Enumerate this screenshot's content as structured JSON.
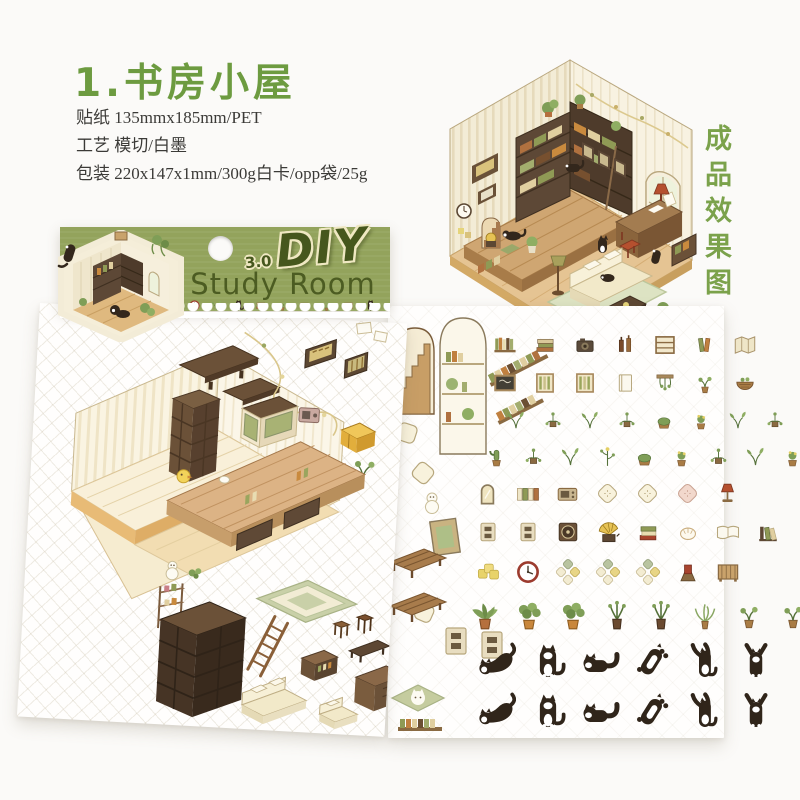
{
  "page": {
    "background": "#fbfaf8"
  },
  "header": {
    "title": "1.书房小屋",
    "specs": [
      "贴纸 135mmx185mm/PET",
      "工艺 模切/白墨",
      "包装 220x147x1mm/300g白卡/opp袋/25g"
    ]
  },
  "side_label": "成品效果图",
  "package_card": {
    "series_version": "3.0",
    "brand": "DIY",
    "product_name": "Study Room",
    "icon_row": [
      "wall-clock",
      "sprig",
      "cat-sit",
      "book-stack",
      "sprout-pot",
      "radio-box",
      "fern-plant",
      "book-stack",
      "cat-sit"
    ]
  },
  "colors": {
    "accent_green": "#6d9b40",
    "label_green": "#7ba24b",
    "card_green": "#93a35c",
    "logo_green": "#46571d",
    "text_dark": "#3b3a37",
    "wood_dark": "#5d4836",
    "wood_mid": "#8a6848",
    "wood_light": "#c9a26b",
    "cream": "#f3ecd2",
    "cat_black": "#30251a",
    "leaf_green": "#7f9e57",
    "rug_sage": "#ccd3ab"
  },
  "left_sheet": {
    "stickers": [
      "room-template",
      "wall-shelf",
      "wall-shelf-small",
      "gold-frame",
      "slat-frame",
      "garland",
      "cubby-shelf",
      "sideboard",
      "mini-radio",
      "yellow-crate",
      "sprig",
      "duck",
      "platform-table",
      "drawer-box",
      "snowman",
      "green-rug",
      "etagere",
      "dark-bookshelf",
      "ladder",
      "sofa",
      "armchair",
      "low-cabinet",
      "stool",
      "stool",
      "bench",
      "desk"
    ]
  },
  "right_sheet": {
    "side_items": [
      "arch-stairs",
      "arch-bookshelf",
      "book-strip",
      "book-strip",
      "cushion",
      "cushion",
      "snowman",
      "photo-frame",
      "bench",
      "bench",
      "cushion",
      "switch-plate",
      "switch-plate",
      "cat-rug",
      "book-strip"
    ],
    "rows": [
      {
        "y": 26,
        "x": 104,
        "size": 26,
        "gap": 14,
        "items": [
          "book-row",
          "book-stack",
          "toy-camera",
          "bottles",
          "slat-shelf",
          "lean-books",
          "folded-map"
        ]
      },
      {
        "y": 64,
        "x": 104,
        "size": 26,
        "gap": 14,
        "items": [
          "blackboard",
          "window-slat",
          "window-slat",
          "white-book",
          "hanging-plant",
          "sprout-pot",
          "basket"
        ]
      },
      {
        "y": 102,
        "x": 116,
        "size": 24,
        "gap": 13,
        "items": [
          "sprig",
          "sprig-drape",
          "sprig",
          "sprig-drape",
          "moss-pot",
          "flower-pot",
          "sprig",
          "sprig-drape"
        ]
      },
      {
        "y": 138,
        "x": 96,
        "size": 25,
        "gap": 12,
        "items": [
          "cactus",
          "sprig-drape",
          "sprig",
          "sprig-tall",
          "moss-pot",
          "flower-pot",
          "sprig-drape",
          "sprig",
          "flower-pot"
        ]
      },
      {
        "y": 174,
        "x": 86,
        "size": 27,
        "gap": 13,
        "items": [
          "mirror",
          "book-files",
          "radio-box",
          "cushion",
          "cushion",
          "cushion-pink",
          "lamp-red"
        ]
      },
      {
        "y": 212,
        "x": 86,
        "size": 28,
        "gap": 12,
        "items": [
          "switch-plate",
          "switch-plate",
          "speaker-box",
          "gramophone",
          "book-stack-red",
          "bun",
          "open-book",
          "bookend"
        ]
      },
      {
        "y": 252,
        "x": 86,
        "size": 28,
        "gap": 12,
        "items": [
          "sticky-notes",
          "wall-clock",
          "cushion-set",
          "cushion-set",
          "cushion-set",
          "book-stand",
          "mini-cabinet"
        ]
      },
      {
        "y": 292,
        "x": 80,
        "size": 34,
        "gap": 10,
        "items": [
          "palm-plant",
          "potted-lush",
          "potted-lush",
          "potted-slim",
          "potted-slim",
          "fern-plant",
          "sprout-pot",
          "sprout-pot",
          "sprout-pot"
        ]
      },
      {
        "y": 336,
        "x": 88,
        "size": 40,
        "gap": 12,
        "items": [
          "cat-stretch",
          "cat-sit",
          "cat-lie",
          "cat-belly",
          "cat-climb",
          "cat-hang"
        ]
      },
      {
        "y": 386,
        "x": 88,
        "size": 40,
        "gap": 12,
        "items": [
          "cat-stretch",
          "cat-sit",
          "cat-lie",
          "cat-belly",
          "cat-climb",
          "cat-hang"
        ]
      }
    ]
  }
}
